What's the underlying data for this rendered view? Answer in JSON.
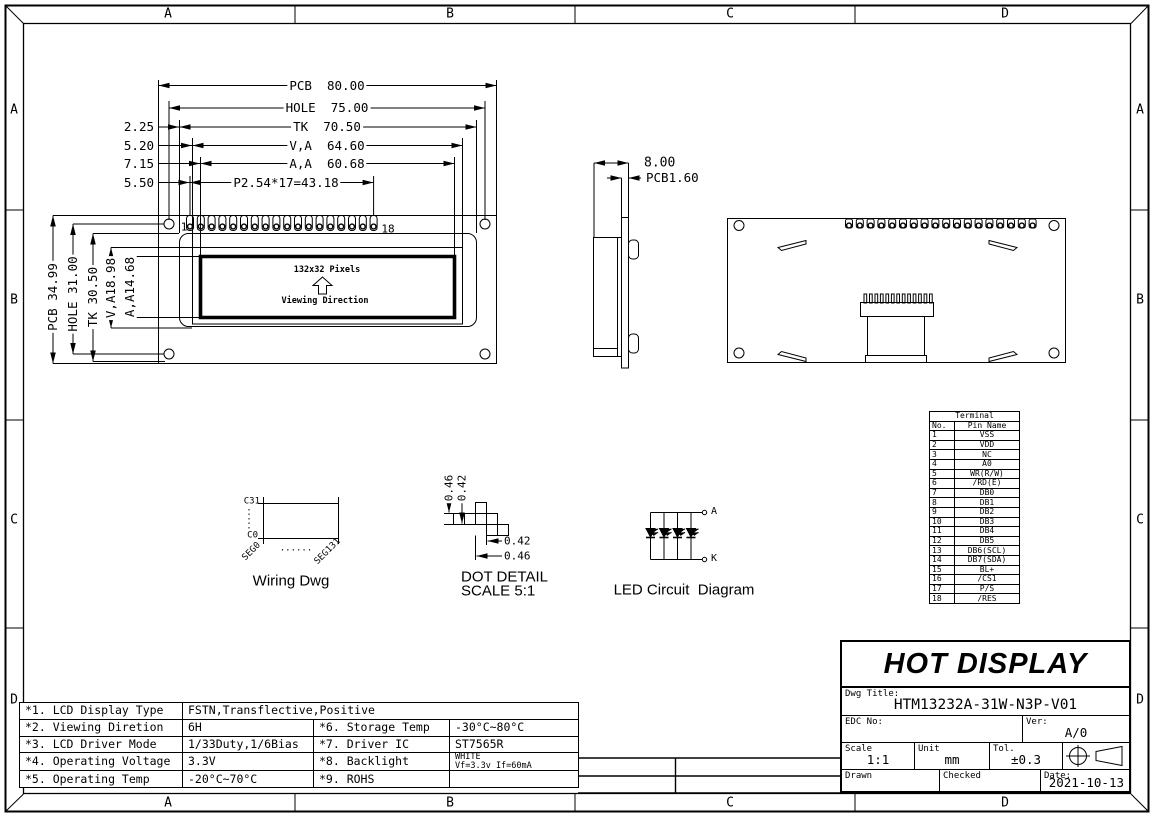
{
  "colors": {
    "line": "#000000",
    "background": "#ffffff"
  },
  "zones": {
    "top": [
      "A",
      "B",
      "C",
      "D"
    ],
    "bottom": [
      "A",
      "B",
      "C",
      "D"
    ],
    "left": [
      "A",
      "B",
      "C",
      "D"
    ],
    "right": [
      "A",
      "B",
      "C",
      "D"
    ]
  },
  "front_view": {
    "dim_pcb_width": "PCB  80.00",
    "dim_hole_width": "HOLE  75.00",
    "dim_tk_width": "TK  70.50",
    "dim_va_width": "V,A  64.60",
    "dim_aa_width": "A,A  60.68",
    "dim_pin_pitch": "P2.54*17=43.18",
    "dim_offset_1": "2.25",
    "dim_offset_2": "5.20",
    "dim_offset_3": "7.15",
    "dim_offset_4": "5.50",
    "dim_pcb_height": "PCB 34.99",
    "dim_hole_height": "HOLE 31.00",
    "dim_tk_height": "TK 30.50",
    "dim_va_height": "V,A18.98",
    "dim_aa_height": "A,A14.68",
    "pin_first": "1",
    "pin_last": "18",
    "display_text": "132x32 Pixels",
    "viewing_direction": "Viewing Direction"
  },
  "side_view": {
    "dim_thickness": "8.00",
    "dim_pcb_thickness": "PCB1.60"
  },
  "wiring_diagram": {
    "com_top": "C31",
    "com_bottom": "C0",
    "seg_first": "SEG0",
    "seg_last": "SEG131",
    "dots": "......",
    "caption": "Wiring Dwg"
  },
  "dot_detail": {
    "dim_v_outer": "0.46",
    "dim_v_inner": "0.42",
    "dim_h_inner": "0.42",
    "dim_h_outer": "0.46",
    "caption_line1": "DOT DETAIL",
    "caption_line2": "SCALE 5:1"
  },
  "led_circuit": {
    "anode": "A",
    "cathode": "K",
    "caption": "LED Circuit  Diagram"
  },
  "terminal_table": {
    "title": "Terminal",
    "col_no": "No.",
    "col_name": "Pin Name",
    "rows": [
      {
        "no": "1",
        "name": "VSS"
      },
      {
        "no": "2",
        "name": "VDD"
      },
      {
        "no": "3",
        "name": "NC"
      },
      {
        "no": "4",
        "name": "A0"
      },
      {
        "no": "5",
        "name": "WR(R/W)"
      },
      {
        "no": "6",
        "name": "/RD(E)"
      },
      {
        "no": "7",
        "name": "DB0"
      },
      {
        "no": "8",
        "name": "DB1"
      },
      {
        "no": "9",
        "name": "DB2"
      },
      {
        "no": "10",
        "name": "DB3"
      },
      {
        "no": "11",
        "name": "DB4"
      },
      {
        "no": "12",
        "name": "DB5"
      },
      {
        "no": "13",
        "name": "DB6(SCL)"
      },
      {
        "no": "14",
        "name": "DB7(SDA)"
      },
      {
        "no": "15",
        "name": "BL+"
      },
      {
        "no": "16",
        "name": "/CS1"
      },
      {
        "no": "17",
        "name": "P/S"
      },
      {
        "no": "18",
        "name": "/RES"
      }
    ]
  },
  "spec_table": {
    "row1_label": "*1. LCD Display Type",
    "row1_value": "FSTN,Transflective,Positive",
    "row2_label1": "*2. Viewing Diretion",
    "row2_value1": "6H",
    "row2_label2": "*6. Storage Temp",
    "row2_value2": "-30°C~80°C",
    "row3_label1": "*3. LCD Driver Mode",
    "row3_value1": "1/33Duty,1/6Bias",
    "row3_label2": "*7. Driver IC",
    "row3_value2": "ST7565R",
    "row4_label1": "*4. Operating Voltage",
    "row4_value1": "3.3V",
    "row4_label2": "*8. Backlight",
    "row4_value2_line1": "WHITE",
    "row4_value2_line2": "Vf=3.3v If=60mA",
    "row5_label1": "*5. Operating Temp",
    "row5_value1": "-20°C~70°C",
    "row5_label2": "*9. ROHS",
    "row5_value2": ""
  },
  "title_block": {
    "brand": "HOT DISPLAY",
    "dwg_title_label": "Dwg Title:",
    "dwg_title": "HTM13232A-31W-N3P-V01",
    "edc_label": "EDC No:",
    "ver_label": "Ver:",
    "ver": "A/0",
    "scale_label": "Scale",
    "scale": "1:1",
    "unit_label": "Unit",
    "unit": "mm",
    "tol_label": "Tol.",
    "tol": "±0.3",
    "drawn_label": "Drawn",
    "checked_label": "Checked",
    "date_label": "Date:",
    "date": "2021-10-13"
  }
}
